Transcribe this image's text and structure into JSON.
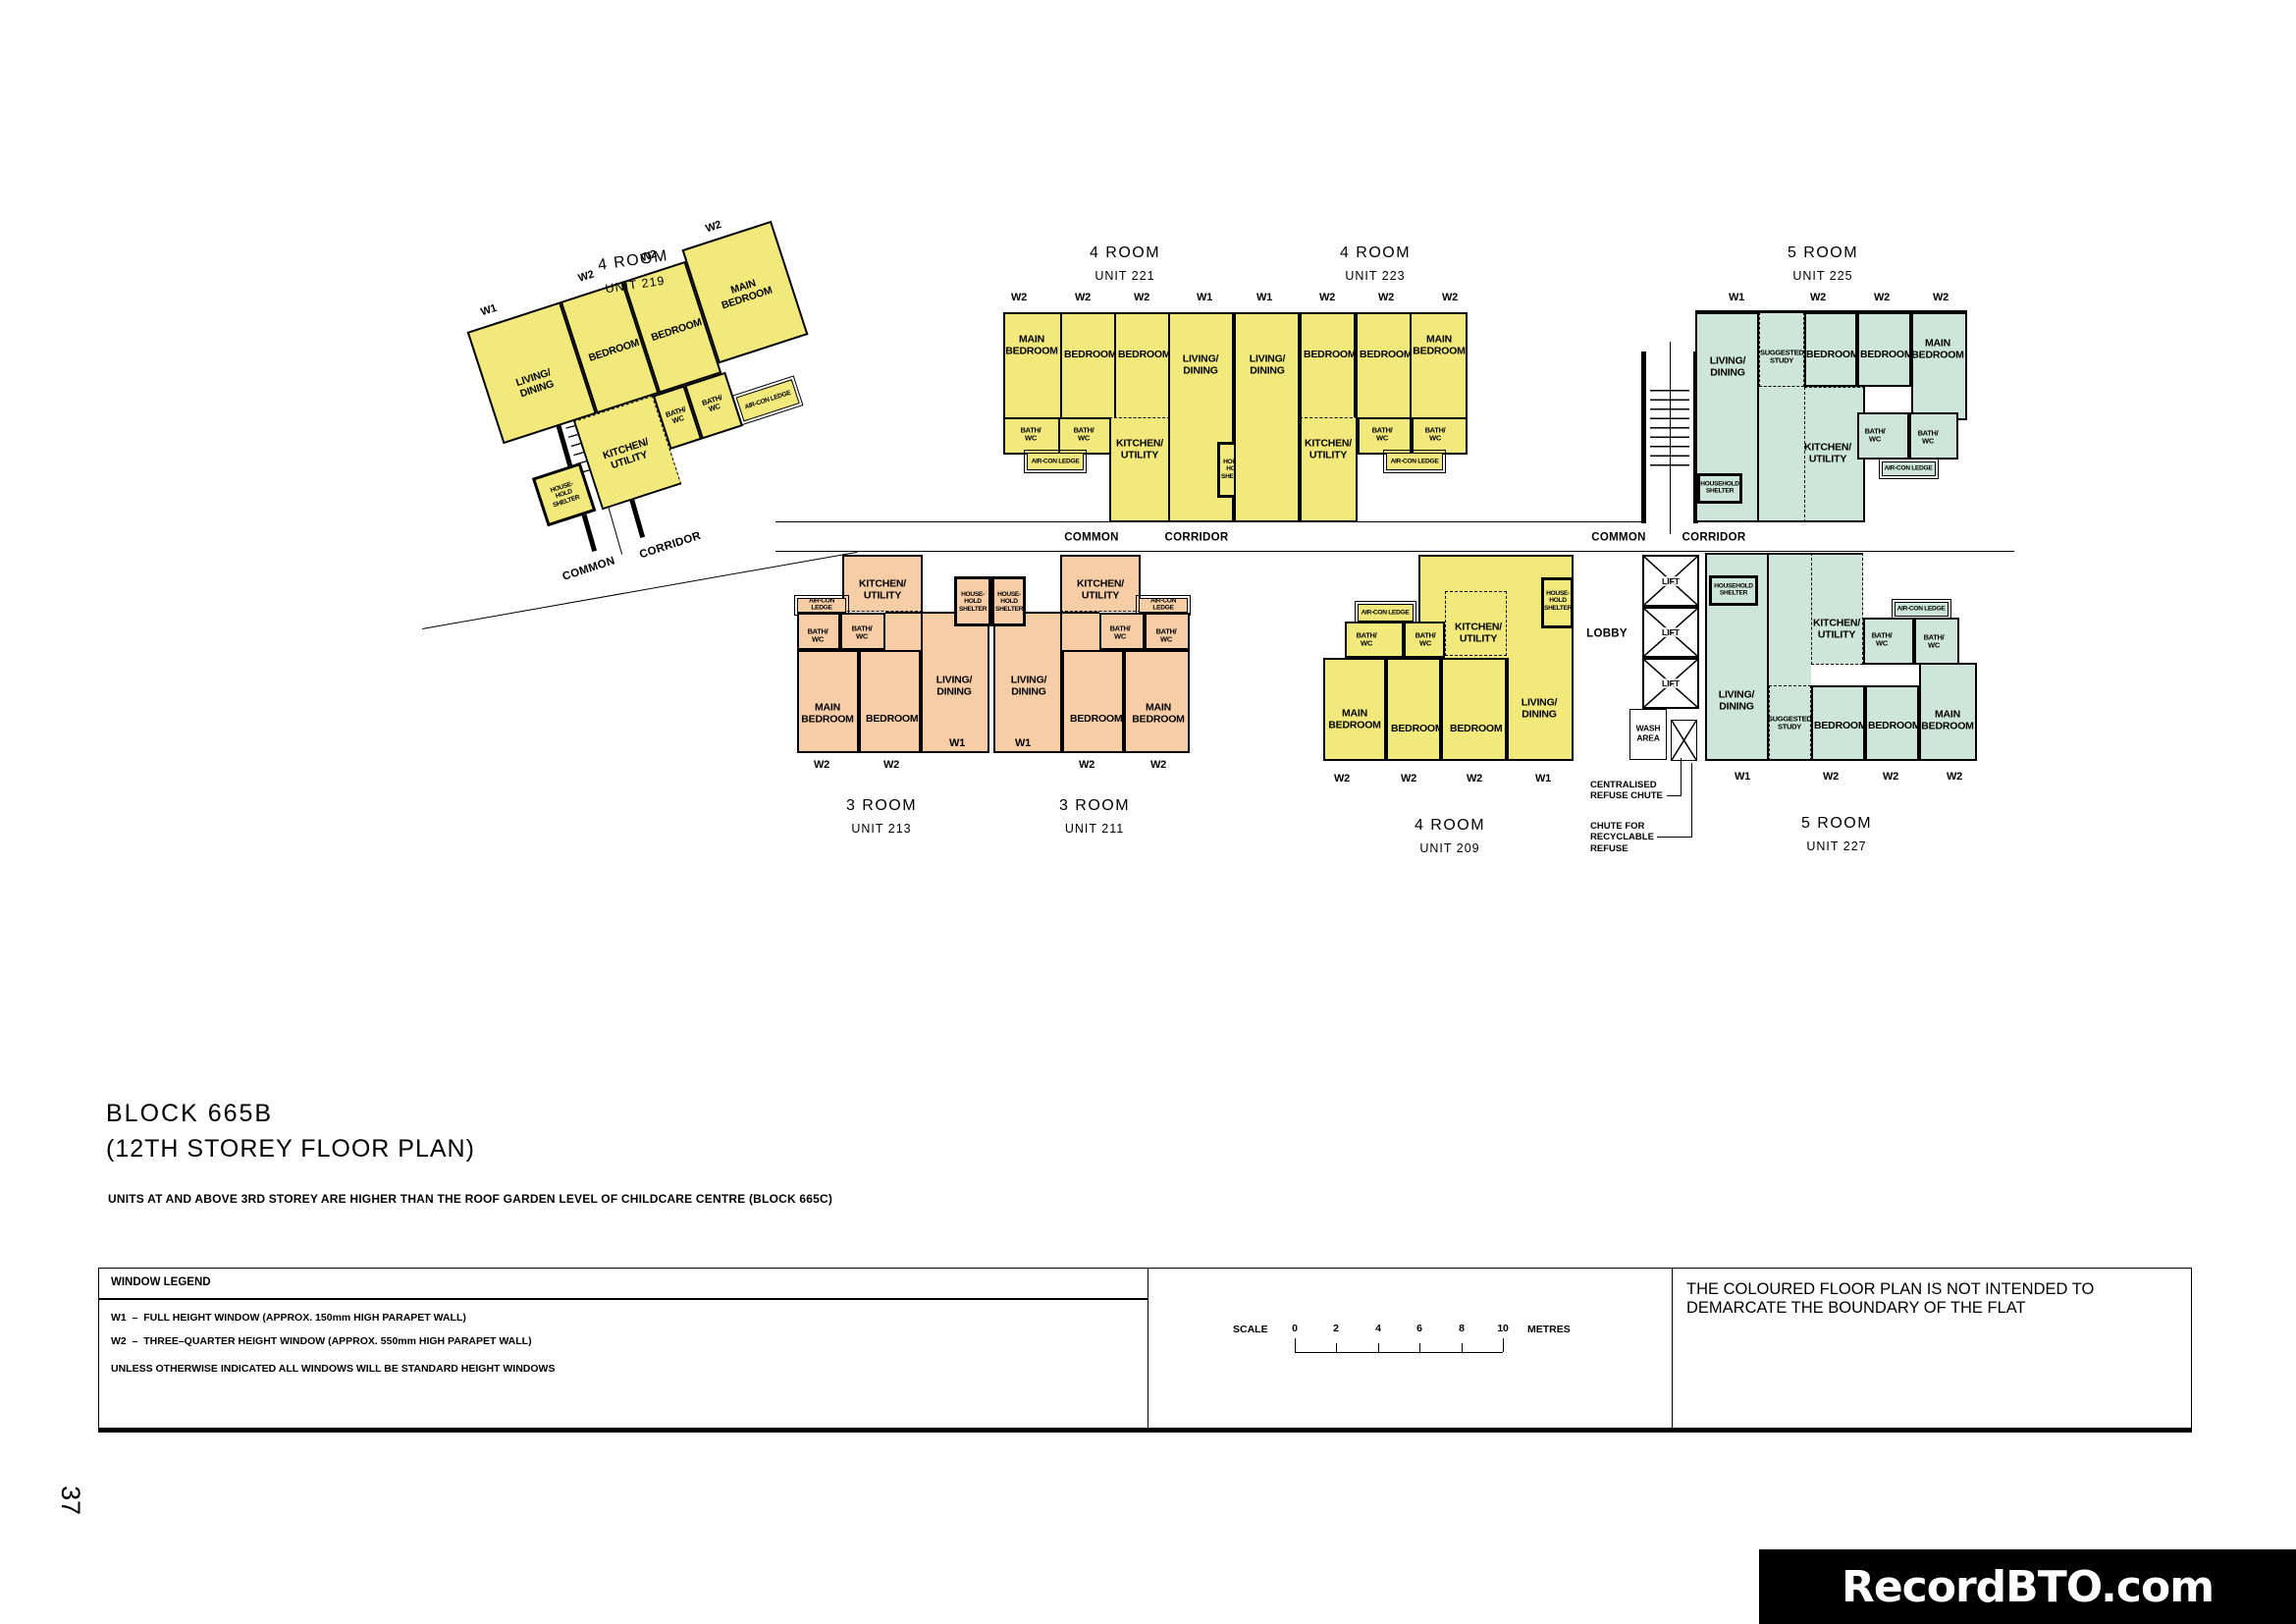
{
  "page": {
    "number": "37",
    "watermark": "RecordBTO.com"
  },
  "header": {
    "block_title": "BLOCK 665B",
    "plan_title": "(12TH STOREY FLOOR PLAN)",
    "note": "UNITS AT AND ABOVE 3RD STOREY ARE HIGHER THAN THE ROOF GARDEN LEVEL OF CHILDCARE CENTRE (BLOCK 665C)"
  },
  "legend": {
    "title": "WINDOW LEGEND",
    "w1_line": "W1  –  FULL HEIGHT WINDOW (APPROX. 150mm HIGH PARAPET WALL)",
    "w2_line": "W2  –  THREE–QUARTER HEIGHT WINDOW (APPROX. 550mm HIGH PARAPET WALL)",
    "note": "UNLESS OTHERWISE INDICATED ALL WINDOWS WILL BE STANDARD HEIGHT WINDOWS"
  },
  "scale": {
    "label": "SCALE",
    "ticks": [
      "0",
      "2",
      "4",
      "6",
      "8",
      "10"
    ],
    "unit": "METRES"
  },
  "disclaimer": "THE COLOURED FLOOR PLAN IS NOT INTENDED TO DEMARCATE THE BOUNDARY OF THE FLAT",
  "colors": {
    "four_room": "#f1e97c",
    "three_room": "#f7cda6",
    "five_room": "#cde6d9",
    "wall": "#000000",
    "watermark_bg": "#000000",
    "watermark_text": "#ffffff"
  },
  "windows": {
    "w1": "W1",
    "w2": "W2"
  },
  "rooms": {
    "living": "LIVING/ DINING",
    "bedroom": "BEDROOM",
    "main_bedroom": "MAIN BEDROOM",
    "kitchen": "KITCHEN/ UTILITY",
    "bath": "BATH/ WC",
    "study": "SUGGESTED STUDY",
    "household_shelter": "HOUSEHOLD SHELTER",
    "household_shelter_small": "HOUSE- HOLD SHELTER",
    "aircon_ledge": "AIR-CON LEDGE"
  },
  "circulation": {
    "common": "COMMON",
    "corridor": "CORRIDOR",
    "lobby": "LOBBY",
    "lift": "LIFT",
    "wash_area": "WASH AREA",
    "refuse_chute": "CENTRALISED REFUSE CHUTE",
    "recyclable_chute": "CHUTE FOR RECYCLABLE REFUSE"
  },
  "units": {
    "u219": {
      "type": "4 ROOM",
      "no": "UNIT 219"
    },
    "u221": {
      "type": "4 ROOM",
      "no": "UNIT 221"
    },
    "u223": {
      "type": "4 ROOM",
      "no": "UNIT 223"
    },
    "u225": {
      "type": "5 ROOM",
      "no": "UNIT 225"
    },
    "u213": {
      "type": "3 ROOM",
      "no": "UNIT 213"
    },
    "u211": {
      "type": "3 ROOM",
      "no": "UNIT 211"
    },
    "u209": {
      "type": "4 ROOM",
      "no": "UNIT 209"
    },
    "u227": {
      "type": "5 ROOM",
      "no": "UNIT 227"
    }
  }
}
